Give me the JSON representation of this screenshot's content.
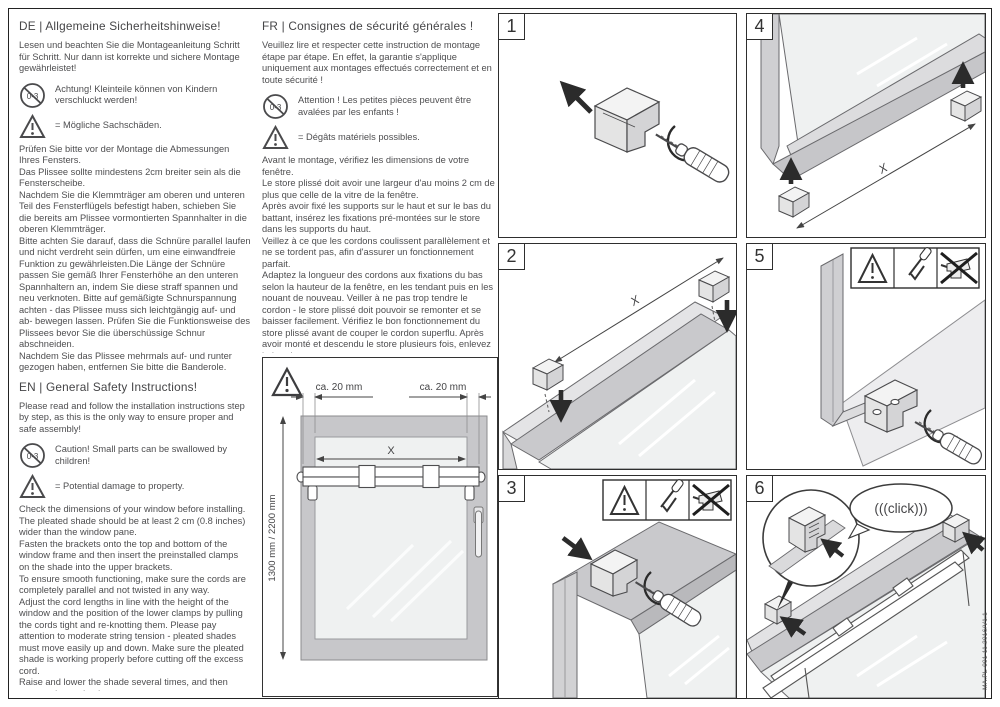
{
  "page": {
    "doc_code": "MA.PL-001 11.2016/V1.1"
  },
  "icons": {
    "age_restriction": "0-3"
  },
  "sections": {
    "de": {
      "title": "DE | Allgemeine Sicherheitshinweise!",
      "intro": "Lesen und beachten Sie die Montageanleitung Schritt für Schritt. Nur dann ist korrekte und sichere Montage gewährleistet!",
      "caution": "Achtung! Kleinteile können von Kindern verschluckt werden!",
      "damage": "= Mögliche Sachschäden.",
      "paragraphs": [
        "Prüfen Sie bitte vor der Montage die Abmessungen Ihres Fensters.",
        "Das Plissee sollte mindestens 2cm breiter sein als die Fensterscheibe.",
        "Nachdem Sie die Klemmträger am oberen und unteren Teil des Fensterflügels befestigt haben, schieben Sie die bereits am Plissee vormontierten Spannhalter in die oberen Klemmträger.",
        "Bitte achten Sie darauf, dass die Schnüre parallel laufen und nicht verdreht sein dürfen, um eine einwandfreie Funktion zu gewährleisten.Die Länge der Schnüre passen Sie gemäß Ihrer Fensterhöhe an den unteren Spannhaltern an, indem Sie diese straff spannen und neu verknoten. Bitte auf gemäßigte Schnurspannung achten - das Plissee muss sich leichtgängig auf- und ab- bewegen lassen. Prüfen Sie die Funktionsweise des Plissees bevor Sie die überschüssige Schnur abschneiden.",
        "Nachdem Sie das Plissee mehrmals auf- und runter gezogen haben, entfernen Sie bitte die Banderole."
      ]
    },
    "en": {
      "title": "EN | General Safety Instructions!",
      "intro": "Please read and follow the installation instructions step by step, as this is the only way to ensure proper and safe assembly!",
      "caution": "Caution! Small parts can be swallowed by children!",
      "damage": "= Potential damage to property.",
      "paragraphs": [
        "Check the dimensions of your window before installing.",
        "The pleated shade should be at least 2 cm (0.8 inches) wider than the window pane.",
        "Fasten the brackets onto the top and bottom of the window frame and then insert the preinstalled clamps on the shade into the upper brackets.",
        "To ensure smooth functioning, make sure the cords are completely parallel and not twisted in any way.",
        "Adjust the cord lengths in line with the height of the window and the position of the lower clamps by pulling the cords tight and re-knotting them. Please pay attention to moderate string tension - pleated shades must move easily up and down. Make sure the pleated shade is working properly before cutting off the excess cord.",
        "Raise and lower the shade several times, and then remove the packaging straps."
      ]
    },
    "fr": {
      "title": "FR | Consignes de sécurité générales !",
      "intro": "Veuillez lire et respecter cette instruction de montage étape par étape. En effet, la garantie s'applique uniquement aux montages effectués correctement et en toute sécurité !",
      "caution": "Attention ! Les petites pièces peuvent être avalées par les enfants !",
      "damage": "= Dégâts matériels possibles.",
      "paragraphs": [
        "Avant le montage, vérifiez les dimensions de votre fenêtre.",
        "Le store plissé doit avoir une largeur d'au moins 2 cm de plus que celle de la vitre de la fenêtre.",
        "Après avoir fixé les supports sur le haut et sur le bas du battant, insérez les fixations pré-montées sur le store dans les supports du haut.",
        "Veillez à ce que les cordons coulissent parallèlement et ne se tordent pas, afin d'assurer un fonctionnement parfait.",
        "Adaptez la longueur des cordons aux fixations du bas selon la hauteur de la fenêtre, en les tendant puis en les nouant de nouveau. Veiller à ne pas trop tendre le cordon - le store plissé doit pouvoir se remonter et se baisser facilement. Vérifiez le bon fonctionnement du store plissé avant de couper le cordon superflu. Après avoir monté et descendu le store plusieurs fois, enlevez la bande."
      ]
    }
  },
  "diagram": {
    "clearance_left": "ca. 20 mm",
    "clearance_right": "ca. 20 mm",
    "width_label": "X",
    "height_label": "1300 mm / 2200 mm"
  },
  "steps": [
    {
      "number": "1"
    },
    {
      "number": "2",
      "dim": "X"
    },
    {
      "number": "3"
    },
    {
      "number": "4",
      "dim": "X"
    },
    {
      "number": "5"
    },
    {
      "number": "6",
      "click": "(((click)))"
    }
  ]
}
